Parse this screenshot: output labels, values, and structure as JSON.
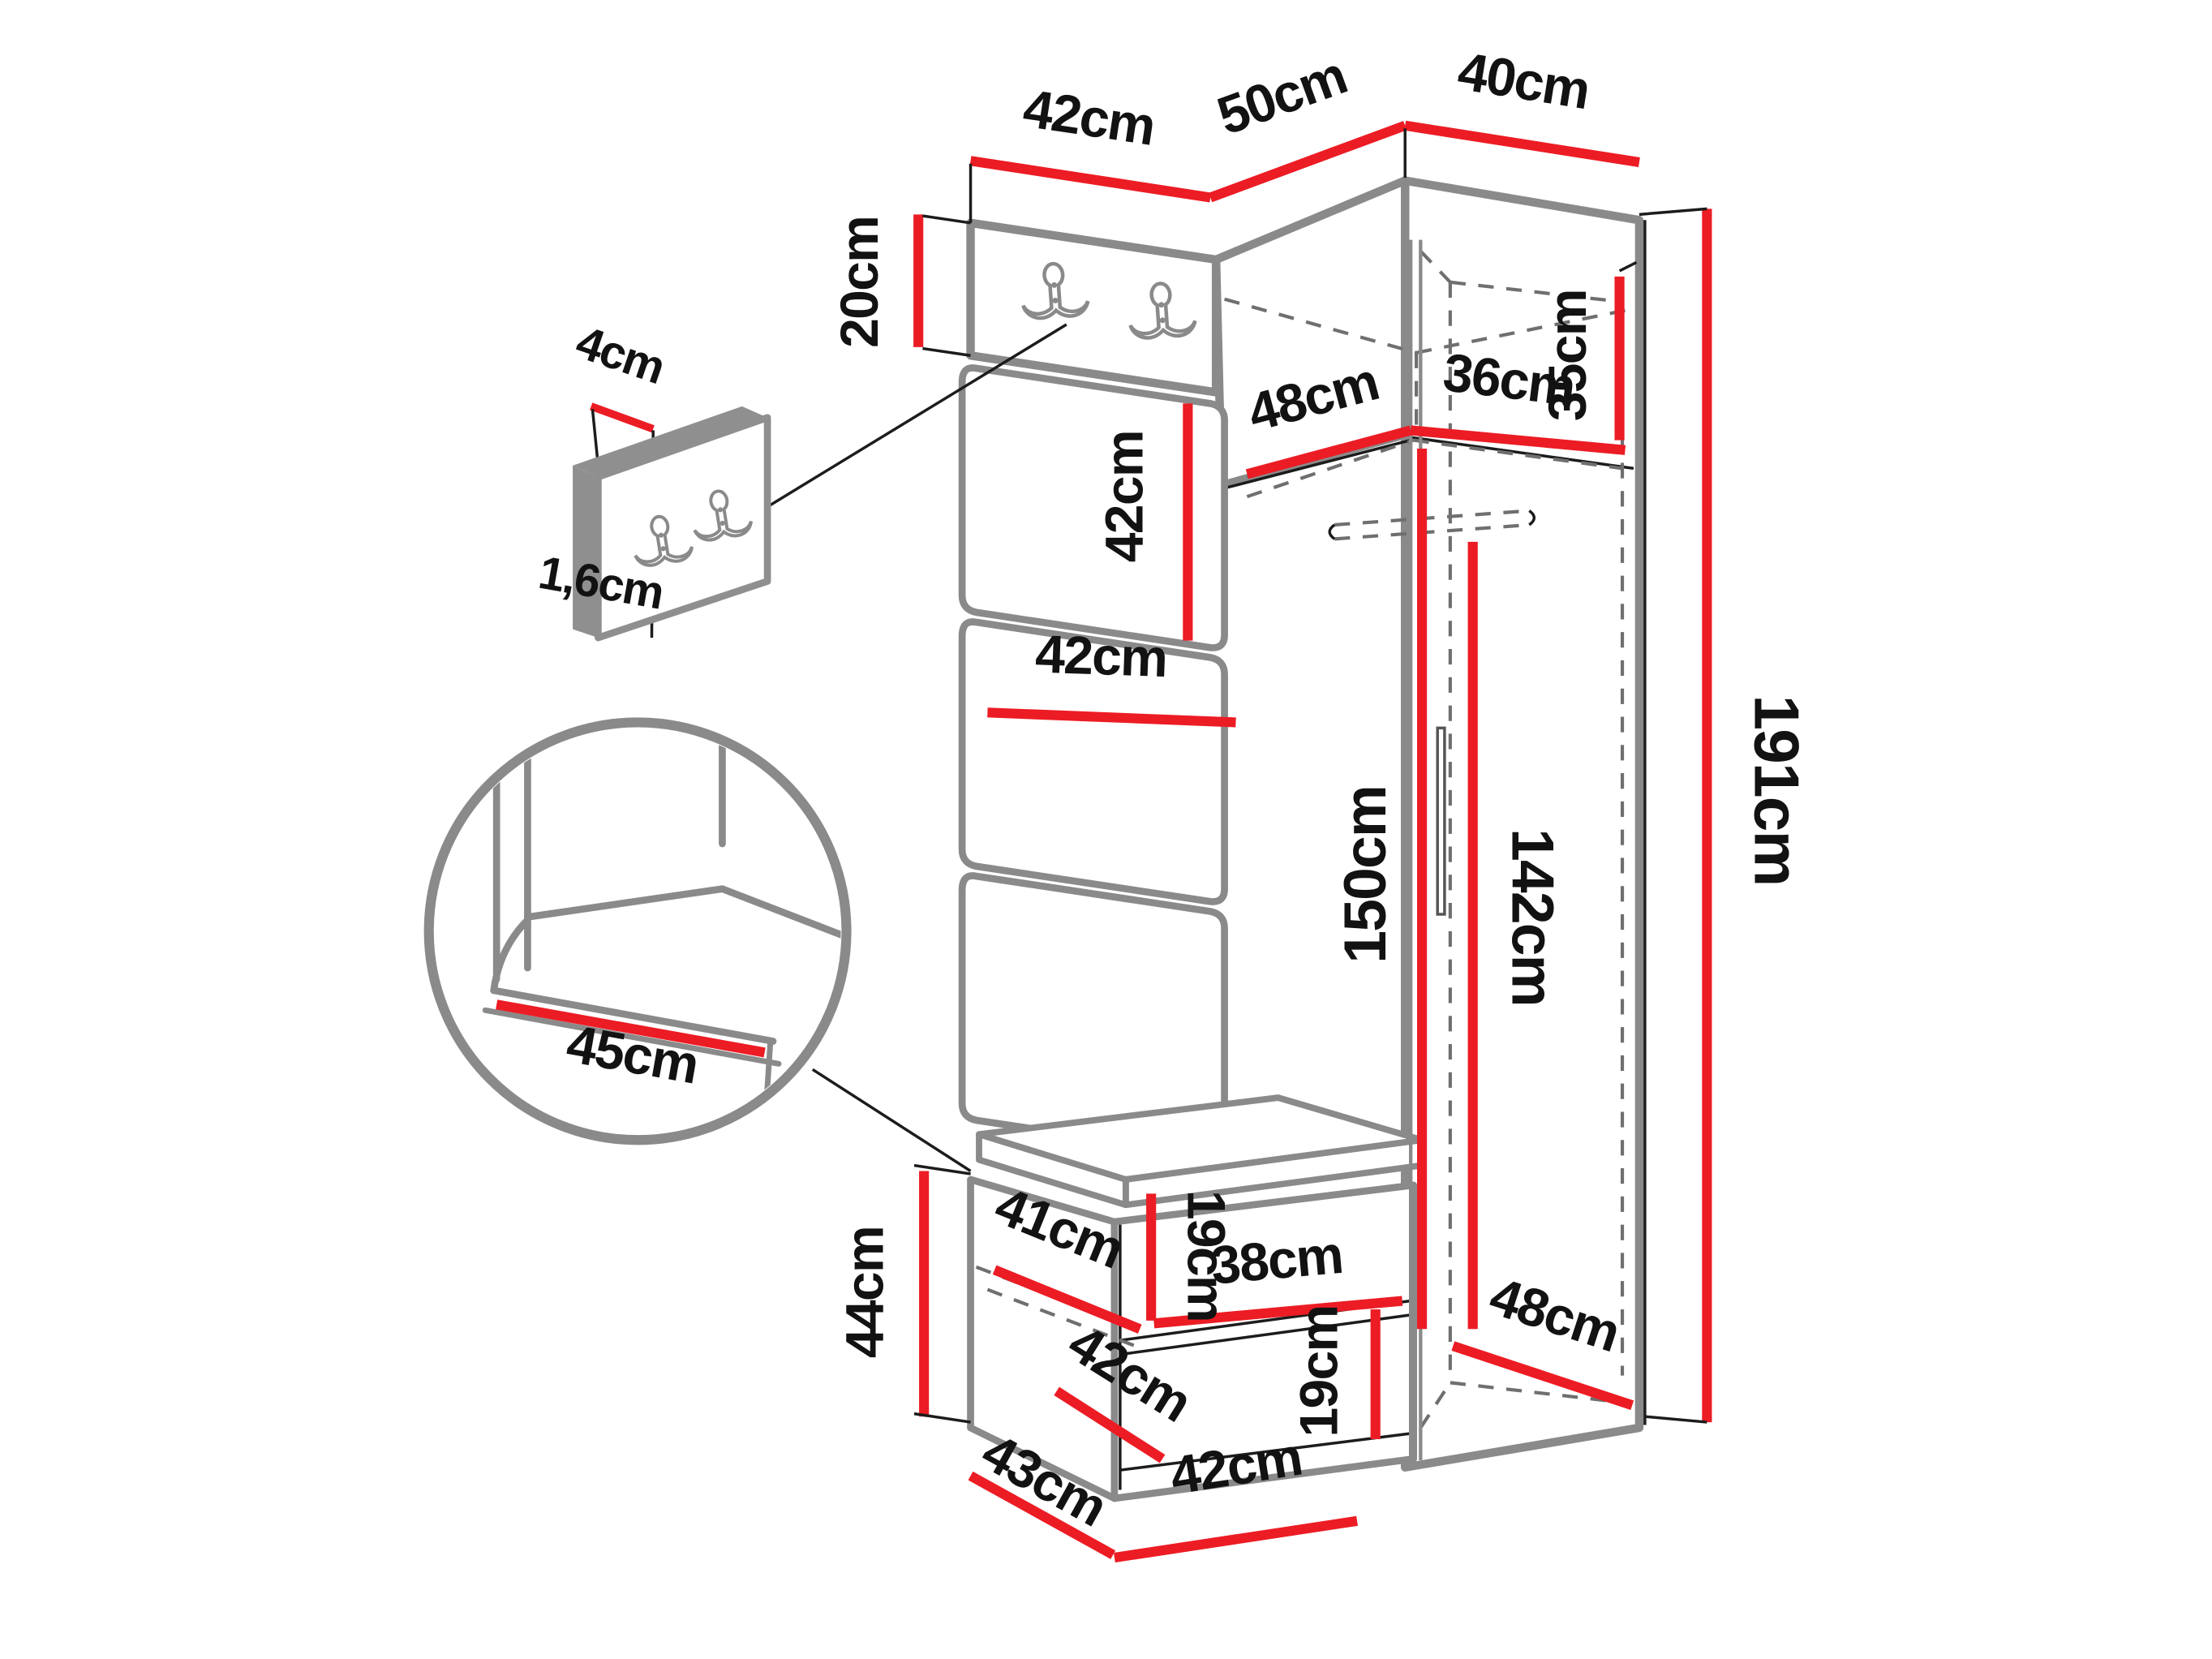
{
  "diagram": {
    "unit": "cm",
    "colors": {
      "dimension_line": "#ec1c24",
      "furniture_outline": "#8a8a8a",
      "detail_line": "#1c1c1c",
      "hidden_edge": "#6f6f6f",
      "text": "#121212",
      "background": "#ffffff"
    }
  },
  "labels": {
    "top_panel_width": "42cm",
    "corner_front_width": "50cm",
    "corner_side_width": "40cm",
    "hook_panel_height": "20cm",
    "detail_panel_width": "4cm",
    "detail_panel_thickness": "1,6cm",
    "cushion_height": "42cm",
    "top_box_depth": "48cm",
    "top_box_width": "36cm",
    "top_box_height": "35cm",
    "cushion_width": "42cm",
    "seat_depth": "45cm",
    "hanging_height": "150cm",
    "door_height": "142cm",
    "total_height": "191cm",
    "bench_height": "44cm",
    "shelf_depth": "41cm",
    "upper_niche_height": "19cm",
    "shelf_width": "38cm",
    "lower_niche_width": "42cm",
    "lower_niche_height": "19cm",
    "bench_depth": "43cm",
    "bench_width": "42cm",
    "wardrobe_floor_depth": "48cm"
  }
}
